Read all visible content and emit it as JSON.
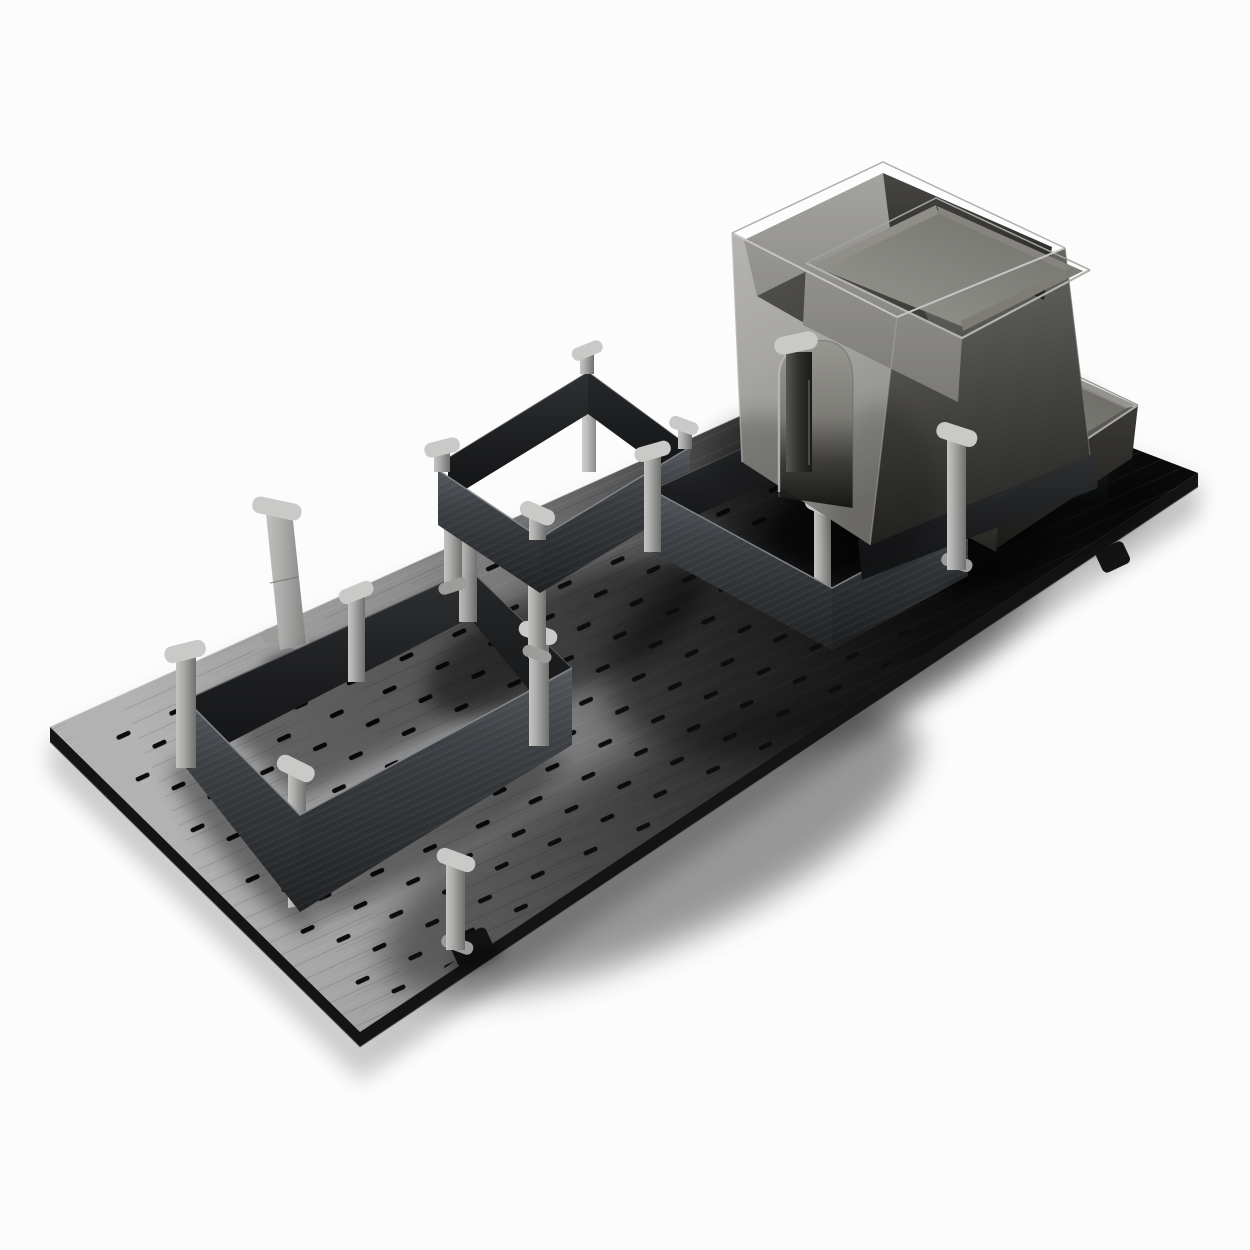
{
  "meta": {
    "type": "product-render",
    "description": "Dark pegboard drawer-organiser base with slotted holes, charcoal divider frames on grey posts, a tall grey container with insert tray, and a shallow grey tray"
  },
  "scene": {
    "objects": [
      "pegboard-base",
      "single-post",
      "large-open-frame",
      "raised-frame-on-posts",
      "middle-square-frame",
      "tall-grey-container",
      "insert-tray",
      "shallow-grey-tray",
      "loose-post"
    ]
  },
  "colors": {
    "background": "#fcfcfc",
    "shadow": "#000000",
    "board_light": "#b2b2b2",
    "board_mid": "#8f8f8f",
    "board_half": "#565656",
    "board_dark": "#1f1f1f",
    "board_black": "#0a0a0a",
    "board_edge": "#141414",
    "board_edge_line": "#707070",
    "slot": "#0d0d0d",
    "panel_hi": "#84888d",
    "panel_top": "#56595d",
    "panel_mid": "#3e4145",
    "panel_low": "#202224",
    "panel2_top": "#4a4d51",
    "panel2_mid": "#33363a",
    "panel2_low": "#1b1d1f",
    "inner_top": "#2f3133",
    "inner_mid": "#1d1e20",
    "inner_low": "#121314",
    "inner2_top": "#26282a",
    "inner2_low": "#101112",
    "back_rim_line": "#5e6266",
    "post_light": "#c4c4c2",
    "post_mid": "#acacaa",
    "post_dim": "#8b8b89",
    "post_dark": "#6f6f6d",
    "cap": "#c9c9c7",
    "foot": "#9c9c9a",
    "dpost_light": "#565654",
    "dpost_mid": "#30302e",
    "dpost_dark": "#1a1a19",
    "lone_light": "#c0c0be",
    "lone_mid": "#ababa9",
    "lone_dark": "#858583",
    "box_front_1": "#b5b4b0",
    "box_front_2": "#a6a5a1",
    "box_front_3": "#92918d",
    "box_front_4": "#7e7d79",
    "box_right_1": "#6e6d69",
    "box_right_2": "#4e4d49",
    "box_right_3": "#282725",
    "box_rim": "#c6c5c1",
    "box_rim_far": "#b0afab",
    "box_inner_back_1": "#a4a39f",
    "box_inner_back_2": "#8e8d89",
    "box_inner_right_1": "#474644",
    "box_inner_right_2": "#232220",
    "box_floor_1": "#55544f",
    "box_floor_2": "#343330",
    "tray_outer_1": "#93928e",
    "tray_outer_2": "#7b7a76",
    "tray_rim": "#b3b2ae",
    "tray_rim_far": "#a3a29e",
    "tray_floor_1": "#989792",
    "tray_floor_2": "#706f6a",
    "tray_wall_far": "#8f8e89",
    "tray_wall_right": "#85847f",
    "tray_wall_near": "#7d7c76",
    "tray2_rim": "#aaa9a5",
    "tray2_rim_far": "#9e9d99",
    "tray2_floor_1": "#8d8c87",
    "tray2_floor_2": "#6b6a65",
    "tray2_front_1": "#504f4b",
    "tray2_front_2": "#242320",
    "tray2_right_1": "#3b3a37",
    "tray2_right_2": "#1b1a18",
    "tray2_wall_dark": "#4f4e4a",
    "tray2_wall_mid": "#5a5954",
    "tray2_wall_far": "#8b8a85",
    "arch_1": "#979691",
    "arch_2": "#7c7b76",
    "arch_3": "#3b3a37",
    "arch_4": "#141413",
    "arch_edge": "#bdbcb8",
    "edge_l": "#b8b7b3",
    "edge_f": "#a3a29f",
    "edge_r": "#787773"
  }
}
